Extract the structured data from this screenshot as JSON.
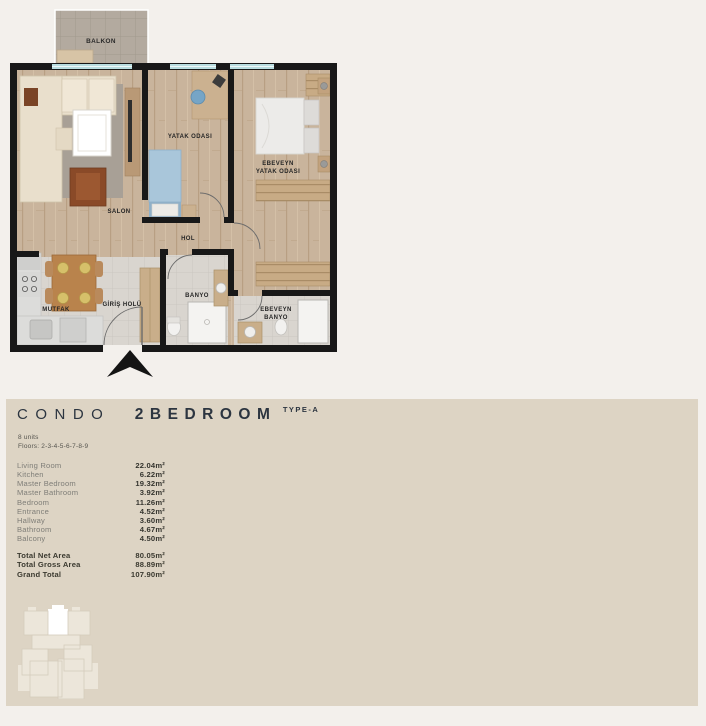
{
  "colors": {
    "page_bg": "#F3F0EC",
    "panel_bg": "#DDD4C4",
    "title_text": "#2C3540",
    "wall": "#181818",
    "wood_floor": "#C9B49C",
    "tile_floor": "#D9D5CF",
    "balcony_tile": "#B3AA9F",
    "window_glass": "#B9DDE0",
    "muted_label": "#7F7E78",
    "value_text": "#34342E",
    "highlight_unit": "#FFFFFF"
  },
  "floor_plan": {
    "rooms": {
      "balcony": "BALKON",
      "living": "SALON",
      "bedroom": "YATAK ODASI",
      "master_line1": "EBEVEYN",
      "master_line2": "YATAK ODASI",
      "hall": "HOL",
      "kitchen": "MUTFAK",
      "entrance_hall": "GİRİŞ HOLÜ",
      "bathroom": "BANYO",
      "master_bath_line1": "EBEVEYN",
      "master_bath_line2": "BANYO"
    },
    "entrance_marker": "north-entrance-arrow"
  },
  "info_panel": {
    "title_light": "CONDO",
    "title_bold": "2BEDROOM",
    "title_type": "TYPE-A",
    "units": "8 units",
    "floors": "Floors: 2-3-4-5-6-7-8-9",
    "areas": [
      {
        "label": "Living Room",
        "value": "22.04m²"
      },
      {
        "label": "Kitchen",
        "value": "6.22m²"
      },
      {
        "label": "Master Bedroom",
        "value": "19.32m²"
      },
      {
        "label": "Master Bathroom",
        "value": "3.92m²"
      },
      {
        "label": "Bedroom",
        "value": "11.26m²"
      },
      {
        "label": "Entrance",
        "value": "4.52m²"
      },
      {
        "label": "Hallway",
        "value": "3.60m²"
      },
      {
        "label": "Bathroom",
        "value": "4.67m²"
      },
      {
        "label": "Balcony",
        "value": "4.50m²"
      }
    ],
    "totals": [
      {
        "label": "Total Net Area",
        "value": "80.05m²"
      },
      {
        "label": "Total Gross Area",
        "value": "88.89m²"
      },
      {
        "label": "Grand Total",
        "value": "107.90m²"
      }
    ]
  }
}
